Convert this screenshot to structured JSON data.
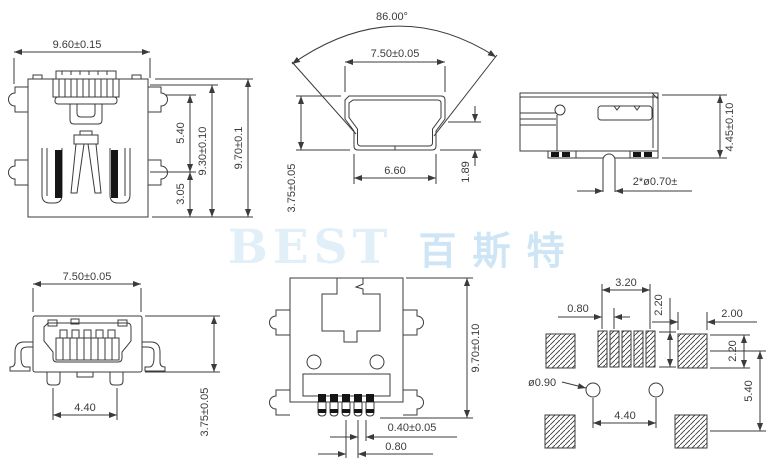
{
  "watermark": {
    "latin": "BEST",
    "chinese": "百斯特"
  },
  "colors": {
    "line": "#3b3b3b",
    "black_fill": "#151515",
    "watermark_latin": "#e1eff9",
    "watermark_chinese": "#cde5f5"
  },
  "views": {
    "rear": {
      "width": "9.60±0.15",
      "latch_height": "5.40",
      "shell_height": "9.30±0.10",
      "overall_height": "9.70±0.1",
      "contact_depth": "3.05"
    },
    "plug": {
      "angle": "86.00°",
      "top_width": "7.50±0.05",
      "bottom_width": "6.60",
      "inner_height": "1.89",
      "height": "3.75±0.05"
    },
    "side": {
      "height": "4.45±0.10",
      "pegs": "2*ø0.70±"
    },
    "front": {
      "width": "7.50±0.05",
      "leg_span": "4.40",
      "height": "3.75±0.05"
    },
    "bottom": {
      "height": "9.70±0.10",
      "pin_width": "0.40±0.05",
      "pin_pitch": "0.80"
    },
    "footprint": {
      "pad_pitch": "0.80",
      "pad_span": "3.20",
      "pad_height": "2.20",
      "side_pad_width": "2.00",
      "side_pad_height": "2.20",
      "row_offset": "5.40",
      "hole_dia": "ø0.90",
      "hole_span": "4.40"
    }
  }
}
